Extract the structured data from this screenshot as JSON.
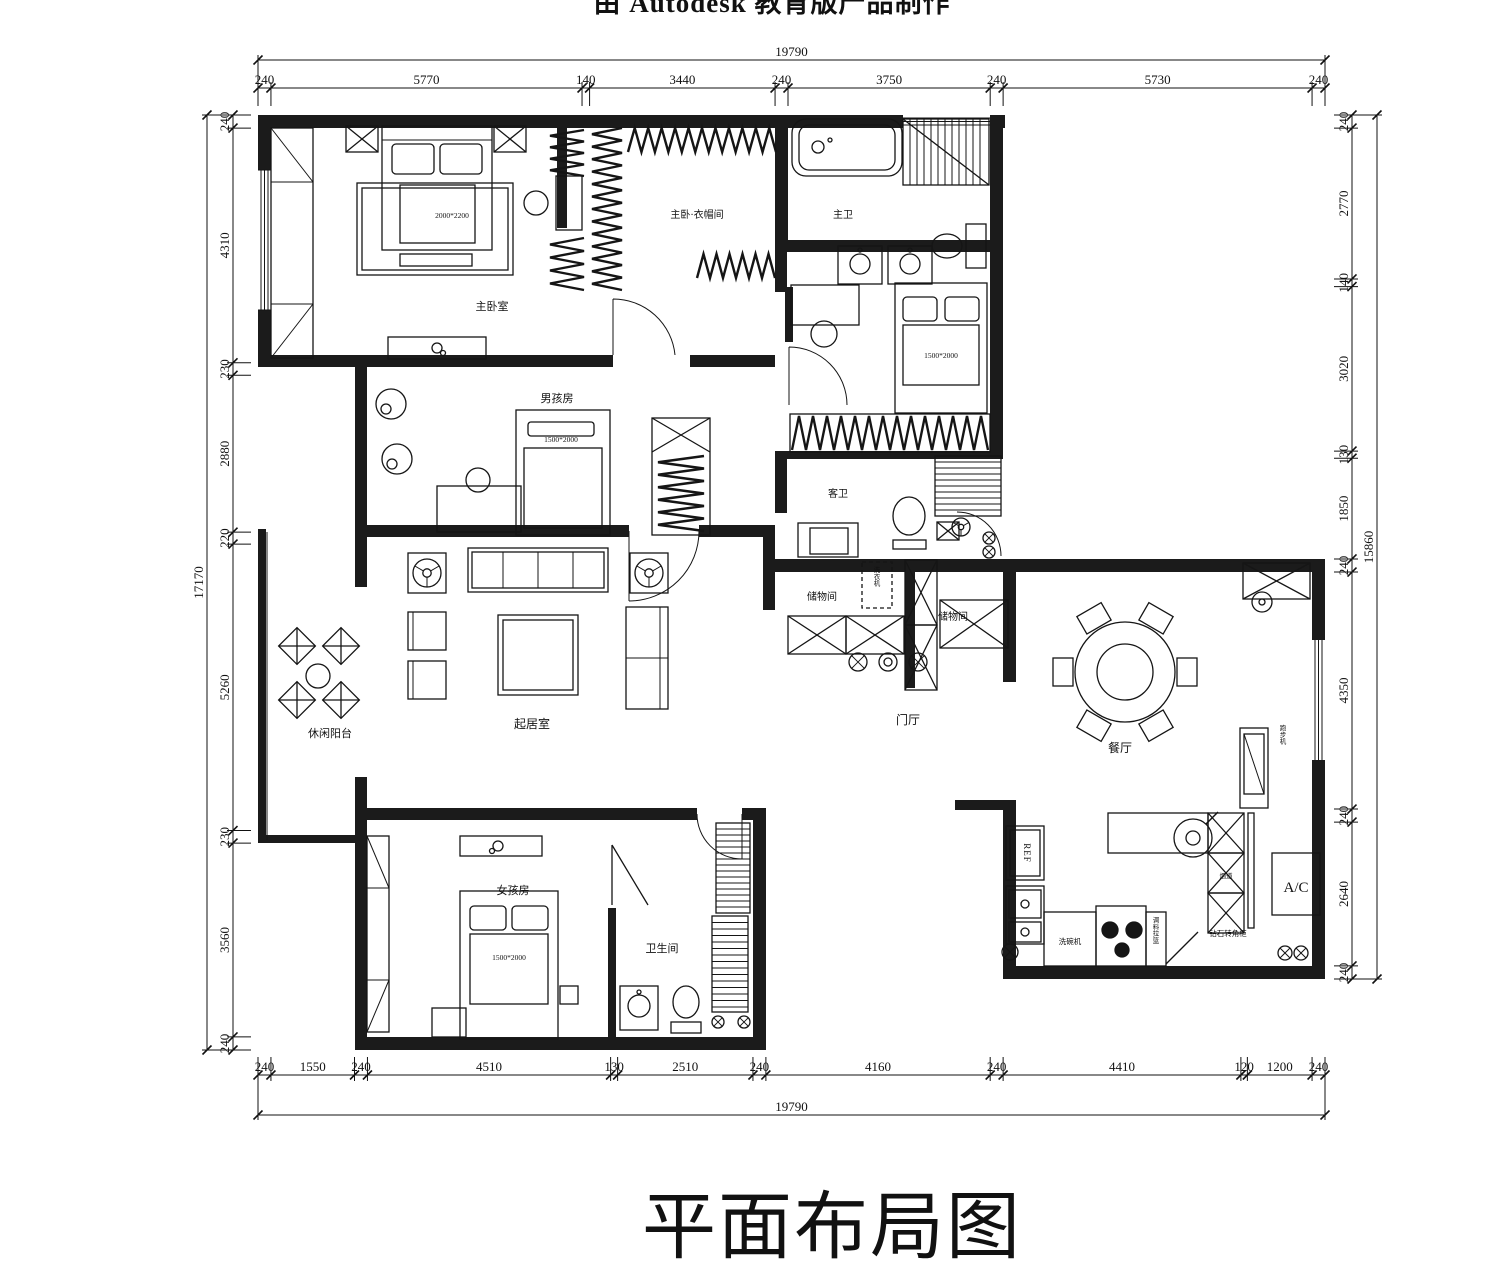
{
  "titles": {
    "watermark": "由 Autodesk 教育版产品制作",
    "plan_title": "平面布局图"
  },
  "rooms": {
    "master_bedroom": "主卧室",
    "master_closet": "主卧·衣帽间",
    "master_bath": "主卫",
    "boys_room": "男孩房",
    "guest_bath": "客卫",
    "storage_1": "储物间",
    "storage_2": "储物间",
    "living_room": "起居室",
    "balcony": "休闲阳台",
    "foyer": "门厅",
    "dining_room": "餐厅",
    "girls_room": "女孩房",
    "bathroom": "卫生间"
  },
  "furniture": {
    "master_bed_size": "2000*2200",
    "bed2_size": "1500*2000",
    "boys_bed_size": "1500*2000",
    "girls_bed_size": "1500*2000",
    "washing_machine": "洗衣机",
    "treadmill": "跑步机",
    "fridge": "REF",
    "ac": "A/C",
    "dishwasher": "洗碗机",
    "spice_basket": "调料拉篮",
    "corner_cabinet": "钻石转角柜",
    "flue": "烟道"
  },
  "dimensions": {
    "top": {
      "total": 19790,
      "segments": [
        240,
        5770,
        140,
        3440,
        240,
        3750,
        240,
        5730,
        240
      ]
    },
    "bottom": {
      "total": 19790,
      "segments": [
        240,
        1550,
        240,
        4510,
        130,
        2510,
        240,
        4160,
        240,
        4410,
        120,
        1200,
        240
      ]
    },
    "left": {
      "total": 17170,
      "segments": [
        240,
        4310,
        230,
        2880,
        220,
        5260,
        230,
        3560,
        240
      ]
    },
    "right": {
      "total": 15860,
      "segments": [
        240,
        2770,
        140,
        3020,
        130,
        1850,
        240,
        4350,
        240,
        2640,
        240
      ]
    }
  }
}
